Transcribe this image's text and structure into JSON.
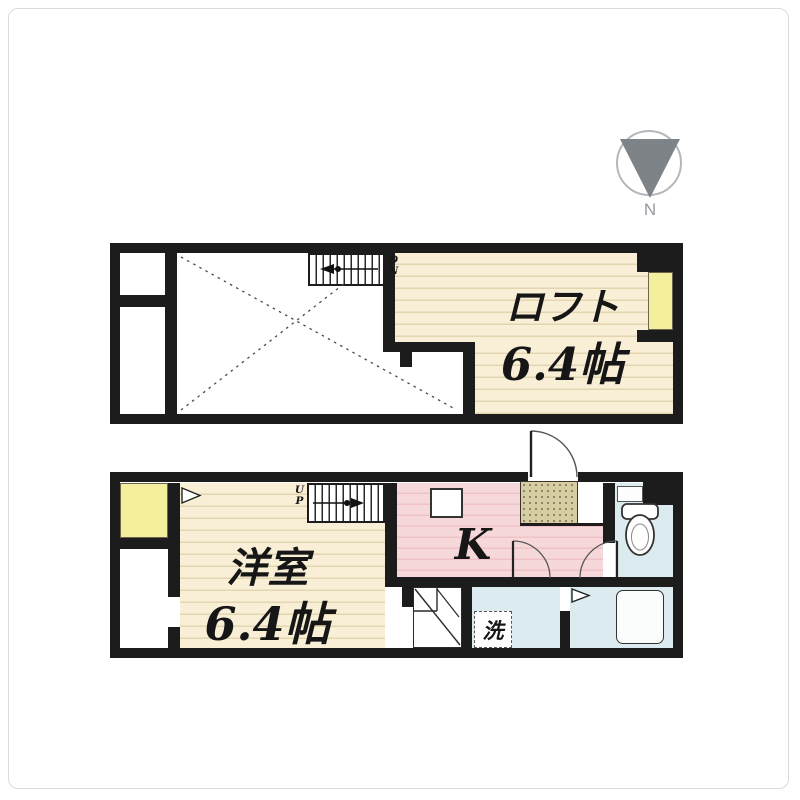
{
  "compass": {
    "north_label": "N"
  },
  "upper_floor": {
    "room_label": "ロフト",
    "room_size": "6.4帖",
    "stairs_direction": "DN"
  },
  "lower_floor": {
    "room_label": "洋室",
    "room_size": "6.4帖",
    "kitchen_label": "K",
    "stairs_direction": "UP",
    "washing_machine_label": "洗"
  },
  "colors": {
    "wall": "#1c1c1c",
    "wood_floor": "#f8efd6",
    "wood_floor_line": "#e2d5b0",
    "kitchen_floor": "#f6d8da",
    "kitchen_floor_line": "#eec2c6",
    "wet_area": "#dcebf0",
    "window_yellow": "#f4ef9c",
    "entrance_mat": "#d6cda2",
    "compass_gray": "#7e8387"
  }
}
